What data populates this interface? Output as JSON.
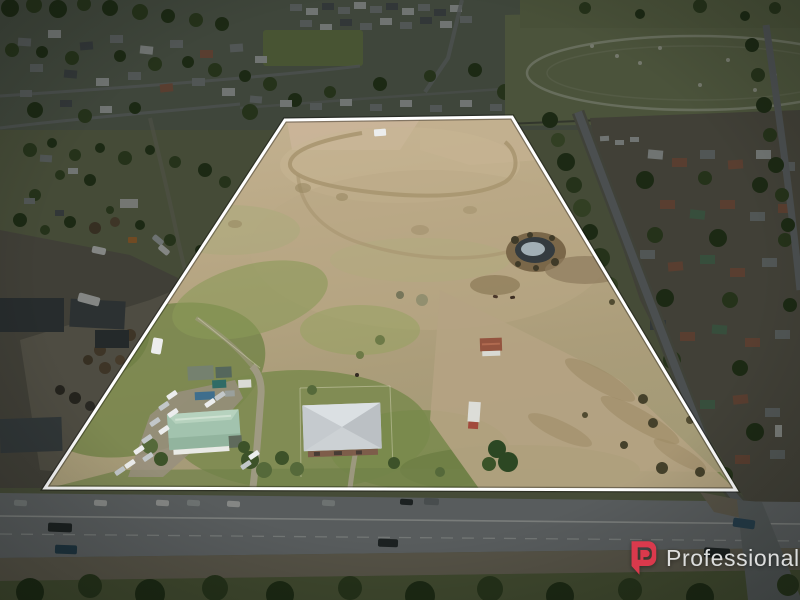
{
  "image": {
    "kind": "real-estate aerial drone photograph",
    "width_px": 800,
    "height_px": 600
  },
  "watermark": {
    "brand": "Professionals",
    "icon": "professionals-p-logo"
  },
  "boundary": {
    "points": "285,120 512,117 736,490 45,488",
    "stroke_width": 3
  },
  "palette": {
    "accent": "#e0394d",
    "watermark-text": "#e3e4e4",
    "boundary-color": "#ffffff",
    "outside-base": "#78805f",
    "town-base": "#6e7666",
    "tree-dark": "#3d5229",
    "dry-grass": "#bcab89",
    "green-grass": "#7b8b4e",
    "scrub": "#b5a383",
    "pond-water": "#343b3f",
    "asphalt": "#9ba0a4",
    "gravel": "#988f7e",
    "dim-overlay": "rgba(8,12,9,0.46)"
  }
}
